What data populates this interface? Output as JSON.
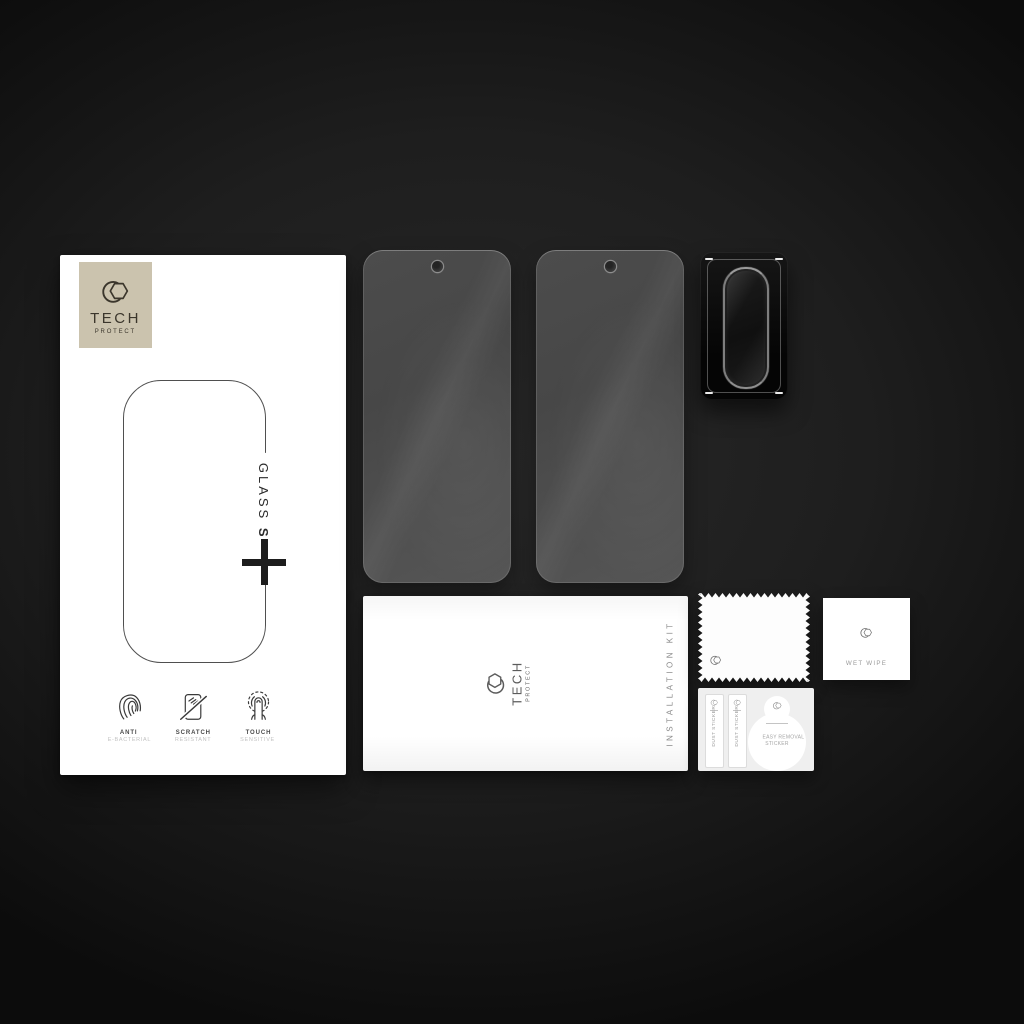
{
  "product": {
    "brand": {
      "logo_icon": "hexagon-brand-icon",
      "line1": "TECH",
      "line2": "PROTECT"
    },
    "box": {
      "series_label_regular": "GLASS",
      "series_label_bold": "SET",
      "plus_symbol": "+",
      "features": [
        {
          "icon": "fingerprint-icon",
          "title": "ANTI",
          "subtitle": "E-BACTERIAL"
        },
        {
          "icon": "scratch-resistant-icon",
          "title": "SCRATCH",
          "subtitle": "RESISTANT"
        },
        {
          "icon": "touch-finger-icon",
          "title": "TOUCH",
          "subtitle": "SENSITIVE"
        }
      ]
    },
    "tempered_glasses": {
      "count": 2,
      "camera_hole": "punch-hole-top-center"
    },
    "lens_protector": {
      "style": "black-frame-oval-glass"
    },
    "installation_kit": {
      "label": "INSTALLATION KIT",
      "brand_line1": "TECH",
      "brand_line2": "PROTECT"
    },
    "wipe_cloth": {
      "shape": "zigzag-edge-cloth"
    },
    "wet_wipe_sachet": {
      "label": "WET WIPE"
    },
    "sticker_sheet": {
      "dust_stickers": [
        "DUST STICKER",
        "DUST STICKER"
      ],
      "removal_sticker_line1": "EASY REMOVAL",
      "removal_sticker_line2": "STICKER"
    }
  },
  "colors": {
    "bg-center": "#282828",
    "bg-edge": "#0c0c0c",
    "brand-beige": "#cbc3ae",
    "brand-ink": "#3b362c",
    "glass-gray": "#4d4d4d",
    "paper": "#ffffff",
    "muted-text": "#a8a8a8"
  }
}
